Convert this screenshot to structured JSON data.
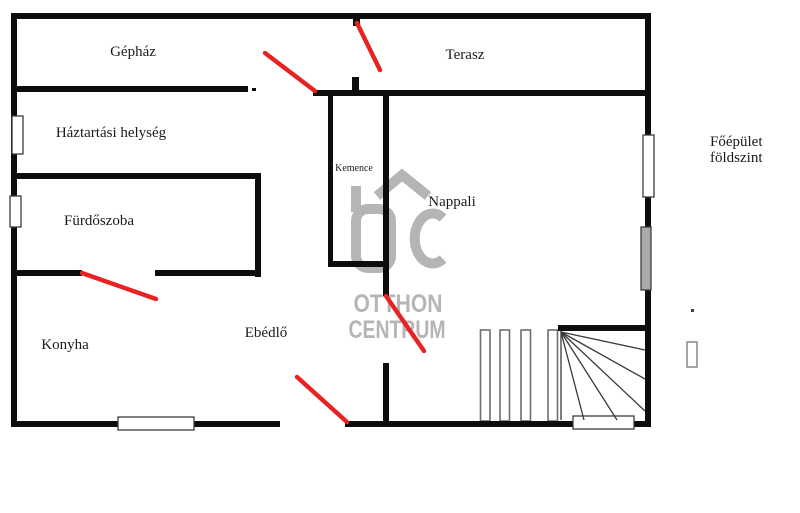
{
  "floor_plan": {
    "rooms": [
      {
        "label": "Gépház"
      },
      {
        "label": "Terasz"
      },
      {
        "label": "Háztartási helység"
      },
      {
        "label": "Fürdőszoba"
      },
      {
        "label": "Kemence"
      },
      {
        "label": "Nappali"
      },
      {
        "label": "Konyha"
      },
      {
        "label": "Ebédlő"
      }
    ],
    "annotation": {
      "line1": "Főépület",
      "line2": "földszint"
    },
    "watermark": {
      "line1": "OTTHON",
      "line2": "CENTRUM"
    }
  },
  "colors": {
    "wall": "#0d0d0d",
    "door": "#e82222",
    "watermark": "#b5b5b5",
    "text": "#1b1b1b"
  }
}
